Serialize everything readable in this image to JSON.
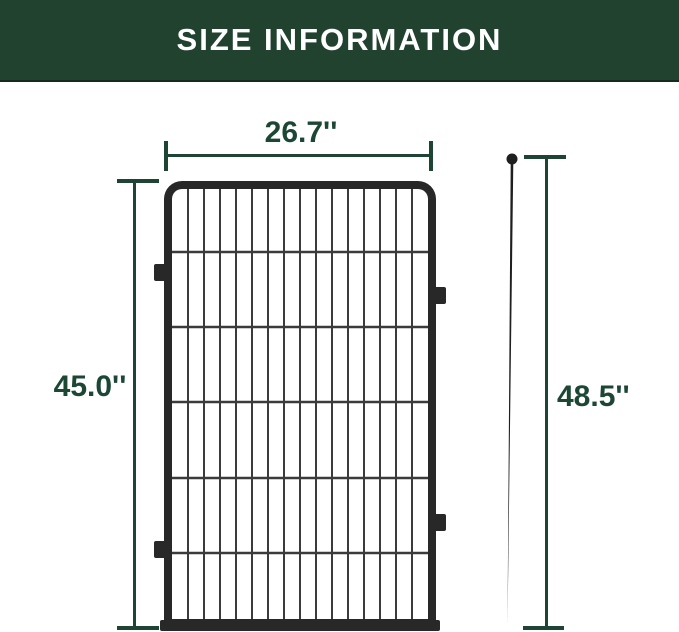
{
  "header": {
    "title": "SIZE INFORMATION"
  },
  "dimensions": {
    "panel_width": {
      "value": "26.7''",
      "description": "fence panel width"
    },
    "panel_height": {
      "value": "45.0''",
      "description": "fence panel height"
    },
    "stake_height": {
      "value": "48.5''",
      "description": "ground stake total height"
    }
  },
  "colors": {
    "header_bg": "#20422f",
    "header_edge": "#142c20",
    "accent_green": "#1e4434",
    "label_green": "#1b4734",
    "fence_dark": "#282828",
    "fence_bar": "#3b3b3b",
    "page_bg": "#ffffff"
  }
}
